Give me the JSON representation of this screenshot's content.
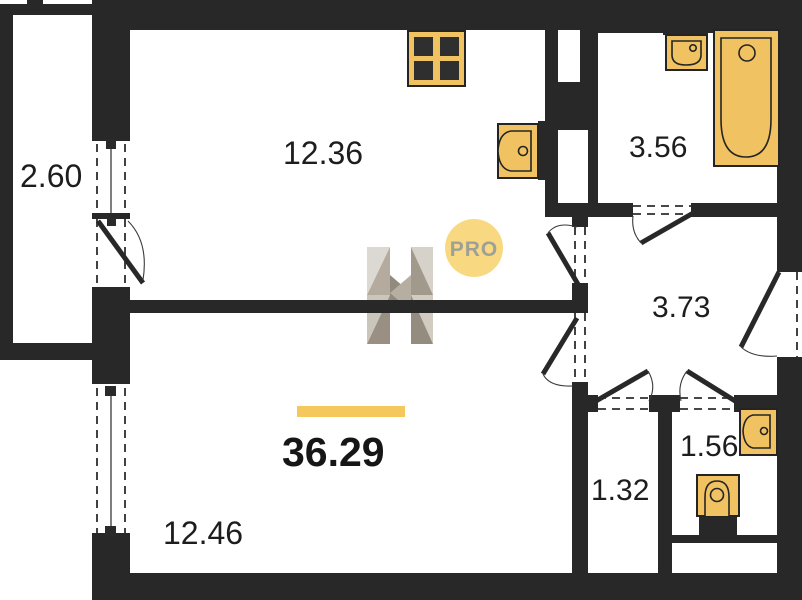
{
  "plan": {
    "type": "apartment-floor-plan",
    "total_area": "36.29",
    "rooms": [
      {
        "name": "balcony",
        "area": "2.60"
      },
      {
        "name": "kitchen-living-room",
        "area": "12.36"
      },
      {
        "name": "bathroom",
        "area": "3.56"
      },
      {
        "name": "hallway",
        "area": "3.73"
      },
      {
        "name": "bedroom",
        "area": "12.46"
      },
      {
        "name": "storage",
        "area": "1.32"
      },
      {
        "name": "wc",
        "area": "1.56"
      }
    ],
    "fixtures": [
      "stove",
      "kitchen-sink",
      "washbasin",
      "bathtub",
      "toilet",
      "wc-washbasin"
    ],
    "watermark": {
      "logo_letter": "H",
      "badge": "PRO"
    },
    "colors": {
      "wall": "#282828",
      "fixture": "#f1c262",
      "accent_bar": "#f5c85e",
      "badge_bg": "#f8d87c",
      "badge_text": "#9a9a94",
      "label": "#1d1d1d"
    }
  }
}
